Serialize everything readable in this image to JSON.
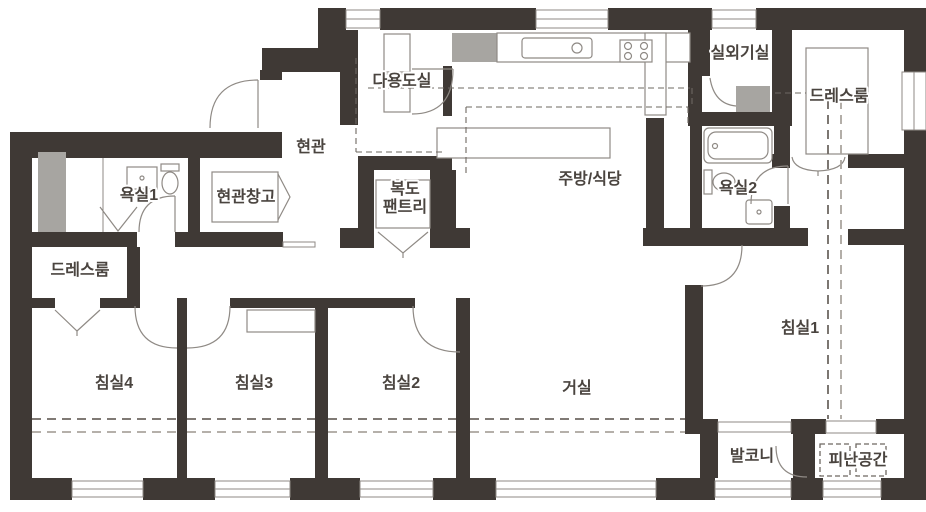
{
  "document": {
    "type": "apartment-floor-plan"
  },
  "colors": {
    "wall": "#3F3935",
    "shaft": "#A7A5A1",
    "line": "#8F8A85",
    "dashA": "#6E6862",
    "dashB": "#ABA59F",
    "label": "#4A443F",
    "bg": "#FFFFFF"
  },
  "rooms": [
    {
      "id": "utility-room",
      "label": "다용도실"
    },
    {
      "id": "outdoor-unit-room",
      "label": "실외기실"
    },
    {
      "id": "dressroom-right",
      "label": "드레스룸"
    },
    {
      "id": "entrance",
      "label": "현관"
    },
    {
      "id": "bathroom1",
      "label": "욕실1"
    },
    {
      "id": "entrance-storage",
      "label": "현관창고"
    },
    {
      "id": "corridor-pantry",
      "label_line1": "복도",
      "label_line2": "팬트리"
    },
    {
      "id": "kitchen-dining",
      "label": "주방/식당"
    },
    {
      "id": "bathroom2",
      "label": "욕실2"
    },
    {
      "id": "dressroom-left",
      "label": "드레스룸"
    },
    {
      "id": "bedroom4",
      "label": "침실4"
    },
    {
      "id": "bedroom3",
      "label": "침실3"
    },
    {
      "id": "bedroom2",
      "label": "침실2"
    },
    {
      "id": "living-room",
      "label": "거실"
    },
    {
      "id": "bedroom1",
      "label": "침실1"
    },
    {
      "id": "balcony",
      "label": "발코니"
    },
    {
      "id": "refuge-space",
      "label": "피난공간"
    }
  ],
  "fixtures": [
    "bathtub",
    "toilet",
    "washbasin",
    "kitchen-sink",
    "gas-stove",
    "washer",
    "wardrobe",
    "closet",
    "dining-table",
    "duct-shaft"
  ]
}
